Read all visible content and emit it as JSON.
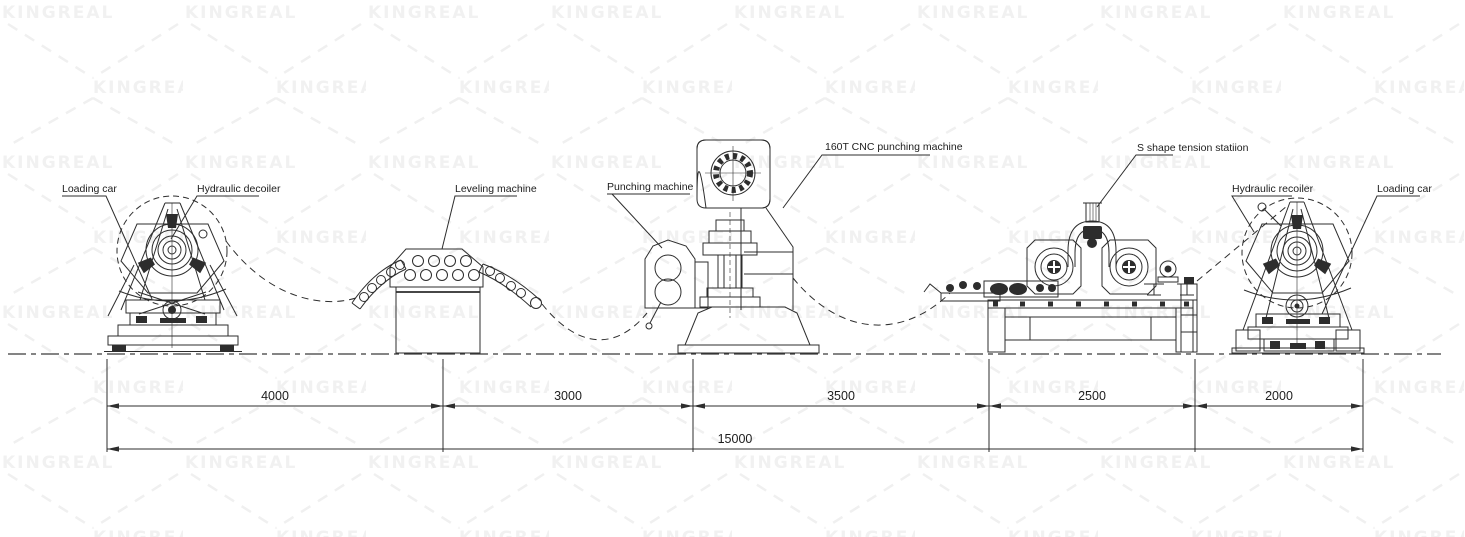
{
  "watermark": {
    "text": "KINGREAL"
  },
  "colors": {
    "line": "#2d2d2d",
    "watermark": "#f1f1f1",
    "background": "#ffffff"
  },
  "labels": {
    "loading_car_left": "Loading car",
    "hydraulic_decoiler": "Hydraulic decoiler",
    "leveling_machine": "Leveling machine",
    "punching_machine": "Punching machine",
    "cnc_punching_machine": "160T CNC punching machine",
    "tension_station": "S shape tension statiion",
    "hydraulic_recoiler": "Hydraulic recoiler",
    "loading_car_right": "Loading car"
  },
  "dimensions": {
    "segments": [
      "4000",
      "3000",
      "3500",
      "2500",
      "2000"
    ],
    "total": "15000"
  }
}
